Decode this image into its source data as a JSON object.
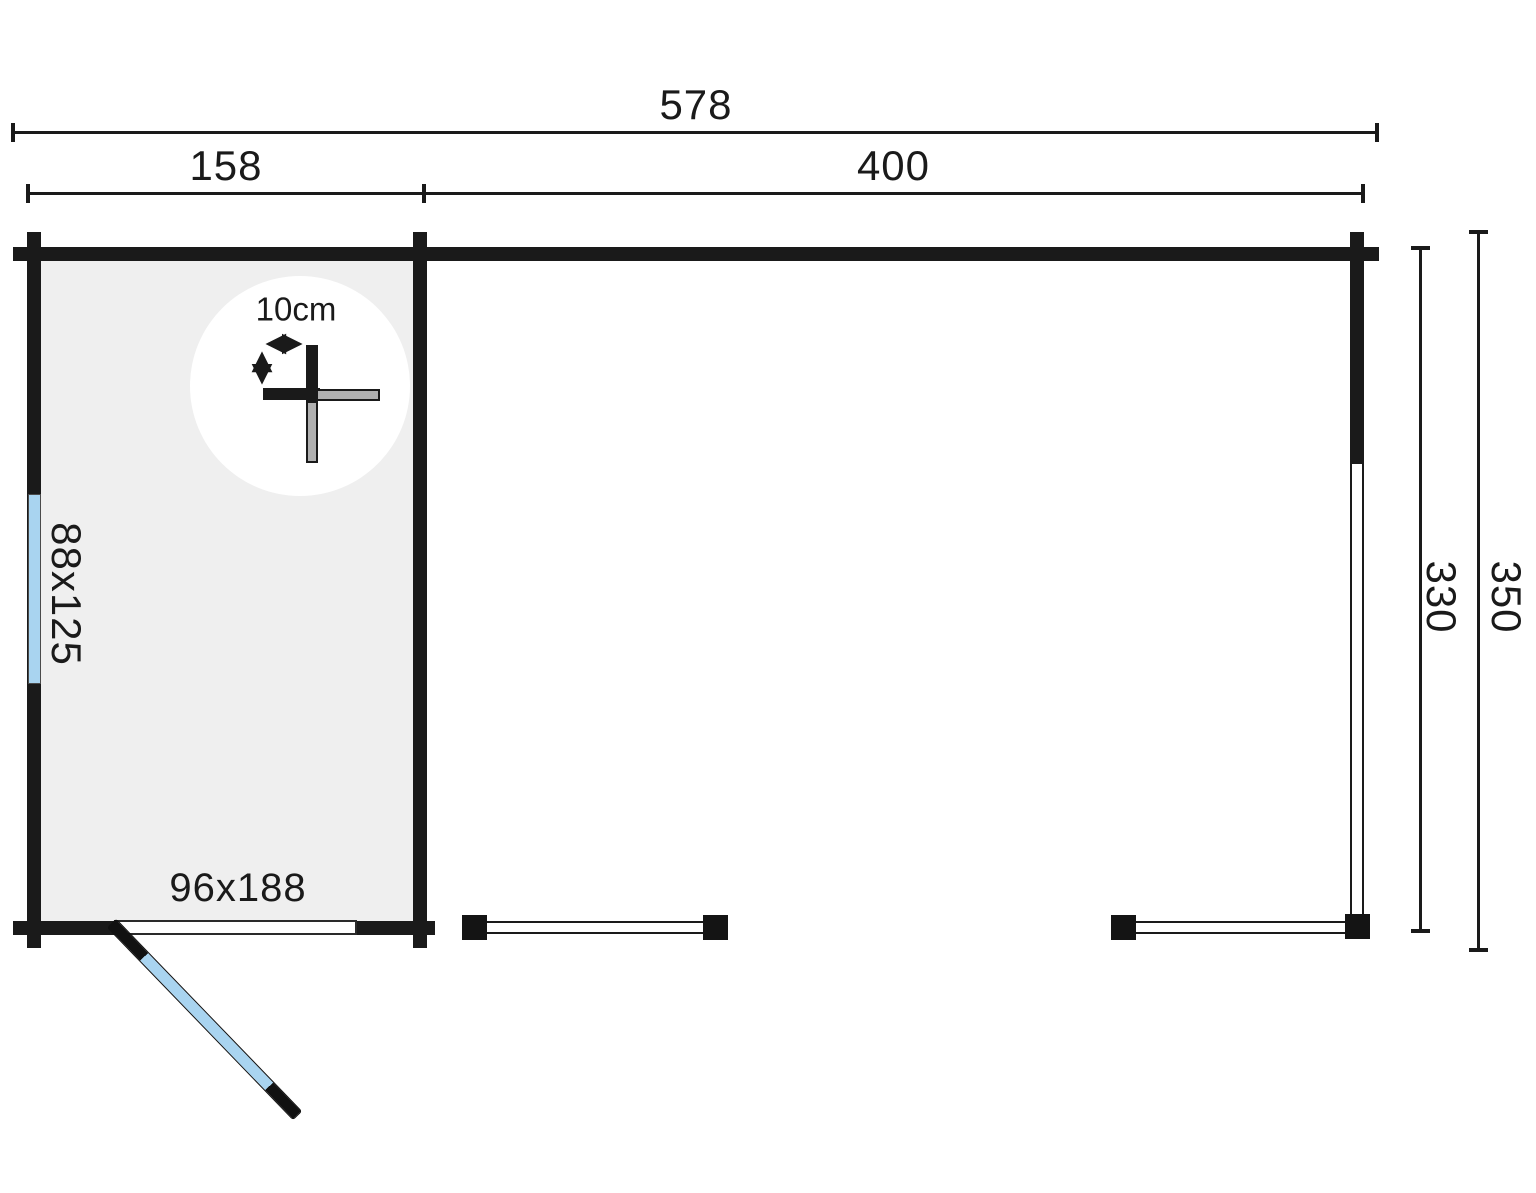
{
  "diagram": {
    "type": "log-cabin floor plan with canopy",
    "dimensions": {
      "total_width": "578",
      "cabin_width": "158",
      "canopy_width": "400",
      "inner_depth": "330",
      "total_depth": "350"
    },
    "features": {
      "window_size": "88x125",
      "door_size": "96x188",
      "wall_thickness": "10cm"
    },
    "colors": {
      "glass_blue": "#a9d4f0",
      "floor_gray": "#efefef",
      "wall_black": "#1a1a1a",
      "log_gray": "#b0b0b0",
      "background": "#ffffff"
    }
  }
}
